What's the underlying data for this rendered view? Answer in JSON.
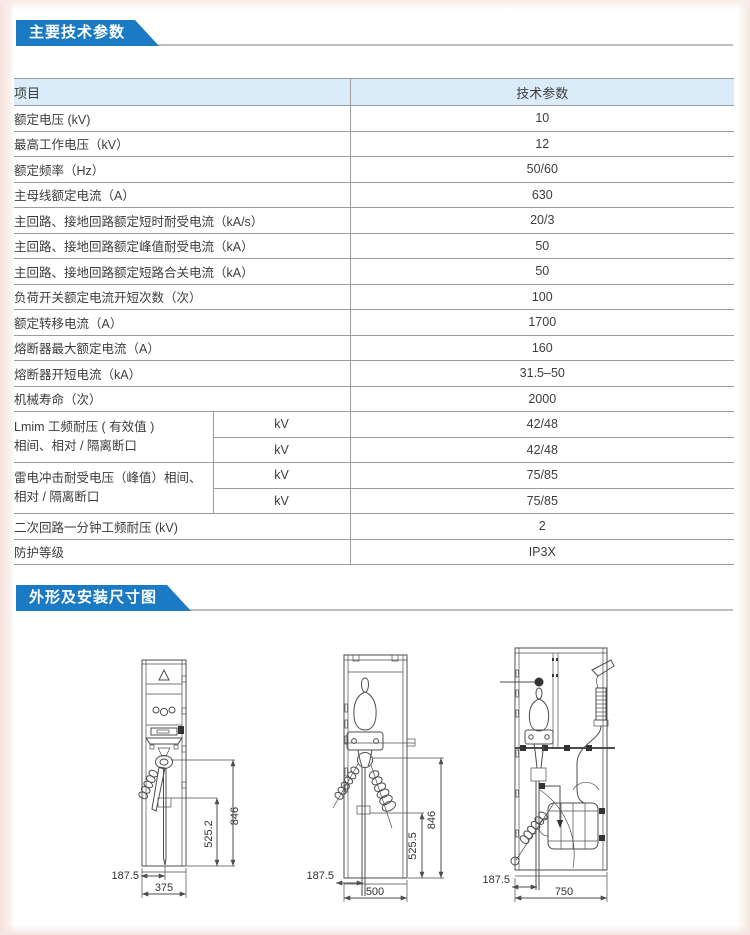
{
  "page": {
    "section1_title": "主要技术参数",
    "section2_title": "外形及安装尺寸图",
    "accent_color": "#1a7ac3",
    "table_header_bg": "#d9ecf8"
  },
  "table": {
    "header": {
      "item": "项目",
      "value": "技术参数"
    },
    "rows": [
      {
        "label": "额定电压 (kV)",
        "value": "10"
      },
      {
        "label": "最高工作电压（kV）",
        "value": "12"
      },
      {
        "label": "额定频率（Hz）",
        "value": "50/60"
      },
      {
        "label": "主母线额定电流（A）",
        "value": "630"
      },
      {
        "label": "主回路、接地回路额定短时耐受电流（kA/s）",
        "value": "20/3"
      },
      {
        "label": "主回路、接地回路额定峰值耐受电流（kA）",
        "value": "50"
      },
      {
        "label": "主回路、接地回路额定短路合关电流（kA）",
        "value": "50"
      },
      {
        "label": "负荷开关额定电流开短次数（次）",
        "value": "100"
      },
      {
        "label": "额定转移电流（A）",
        "value": "1700"
      },
      {
        "label": "熔断器最大额定电流（A）",
        "value": "160"
      },
      {
        "label": "熔断器开短电流（kA）",
        "value": "31.5–50"
      },
      {
        "label": "机械寿命（次）",
        "value": "2000"
      },
      {
        "label": "二次回路一分钟工频耐压 (kV)",
        "value": "2"
      },
      {
        "label": "防护等级",
        "value": "IP3X"
      }
    ],
    "merged": [
      {
        "label_line1": "Lmim 工频耐压 ( 有效值 )",
        "label_line2": "相间、相对 / 隔离断口",
        "unit": "kV",
        "values": [
          "42/48",
          "42/48"
        ]
      },
      {
        "label_line1": "雷电冲击耐受电压（峰值）相间、",
        "label_line2": "相对 / 隔离断口",
        "unit": "kV",
        "values": [
          "75/85",
          "75/85"
        ]
      }
    ]
  },
  "drawings": {
    "left": {
      "total_height": "846",
      "inner_height": "525.2",
      "offset": "187.5",
      "width": "375"
    },
    "middle": {
      "total_height": "846",
      "inner_height": "525.5",
      "offset": "187.5",
      "width": "500"
    },
    "right": {
      "offset": "187.5",
      "width": "750"
    }
  }
}
